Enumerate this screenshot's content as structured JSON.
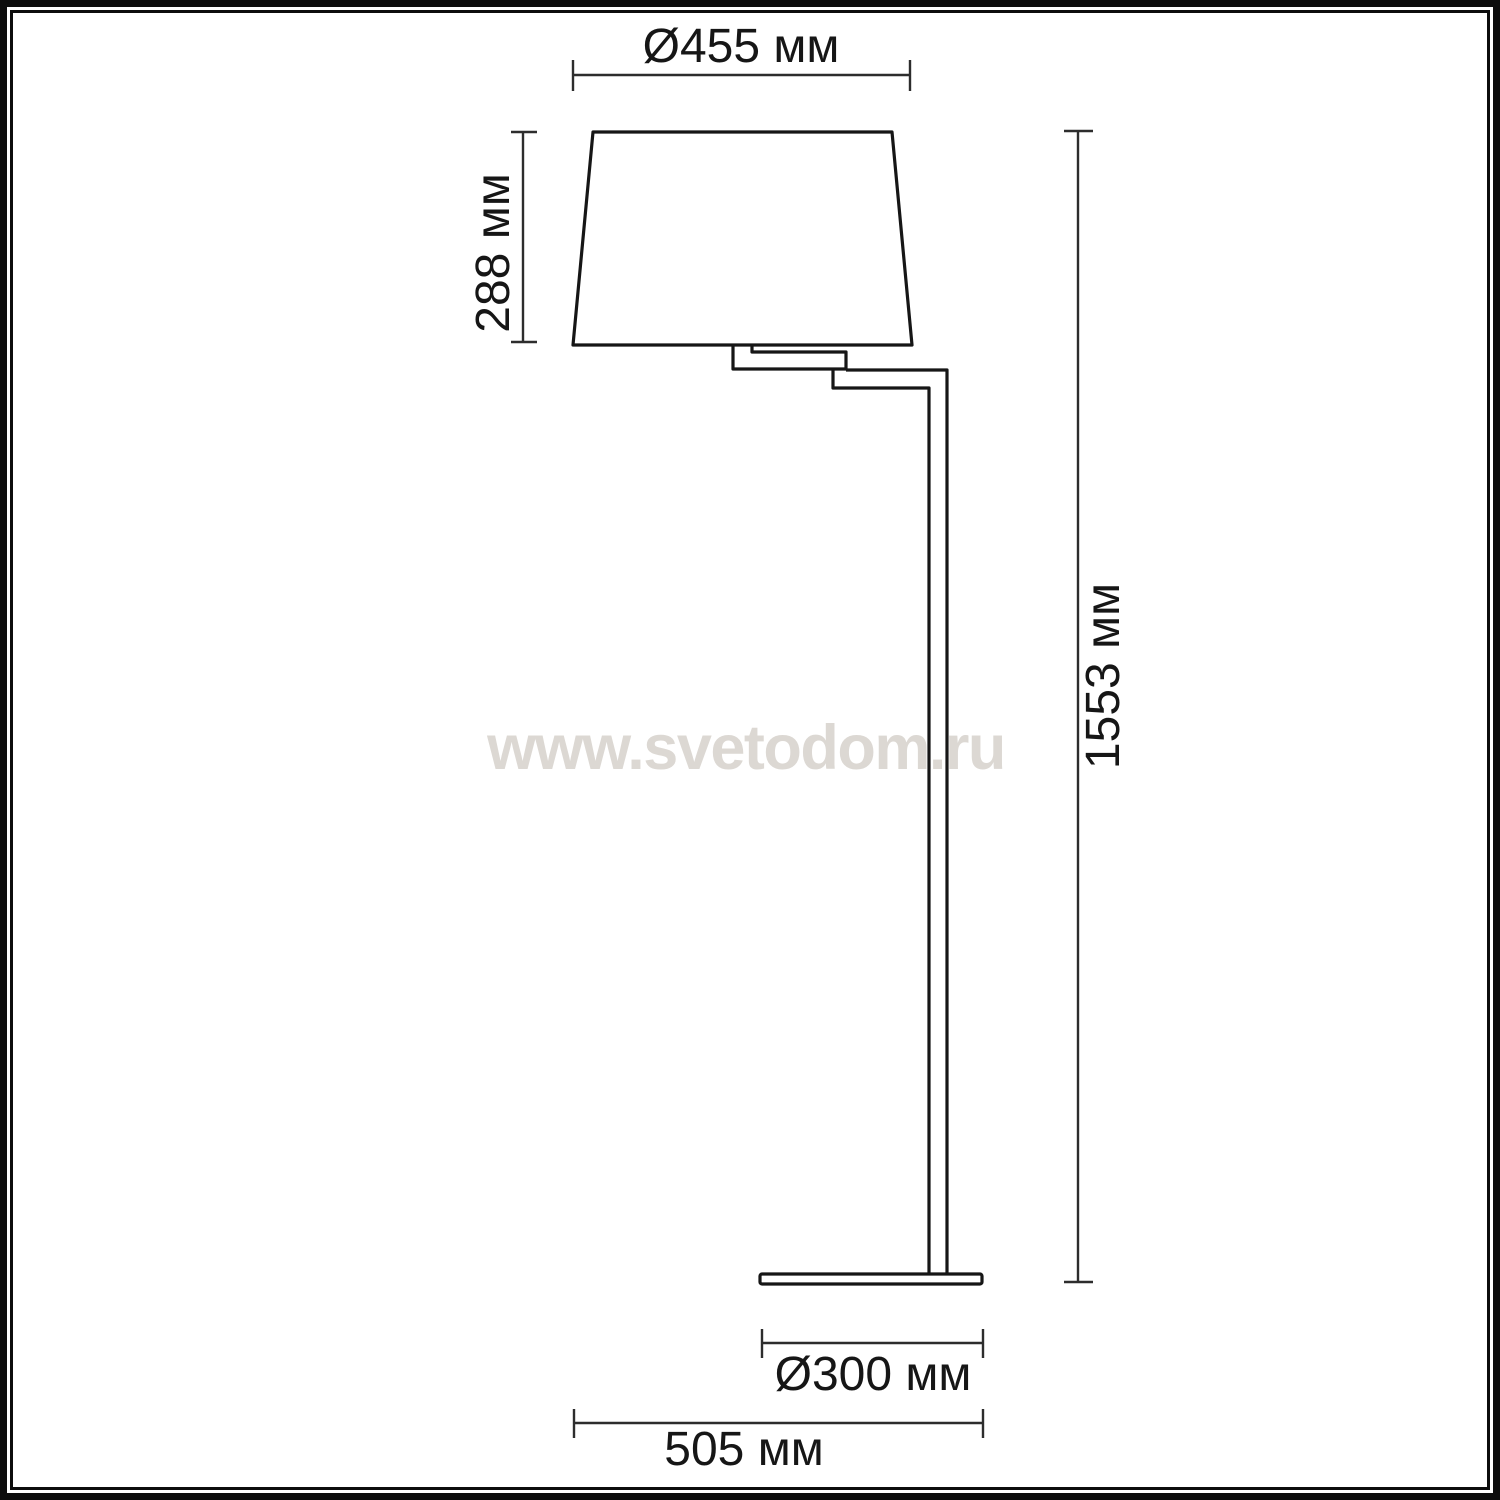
{
  "watermark": "www.svetodom.ru",
  "dimensions": {
    "shade_diameter": "Ø455 мм",
    "shade_height": "288 мм",
    "total_height": "1553 мм",
    "base_diameter": "Ø300 мм",
    "overall_width": "505 мм"
  },
  "colors": {
    "line": "#161616",
    "dimension_line": "#2d2d2d",
    "watermark": "#dcd8d3",
    "frame": "#0d0d0d",
    "background": "#ffffff"
  }
}
